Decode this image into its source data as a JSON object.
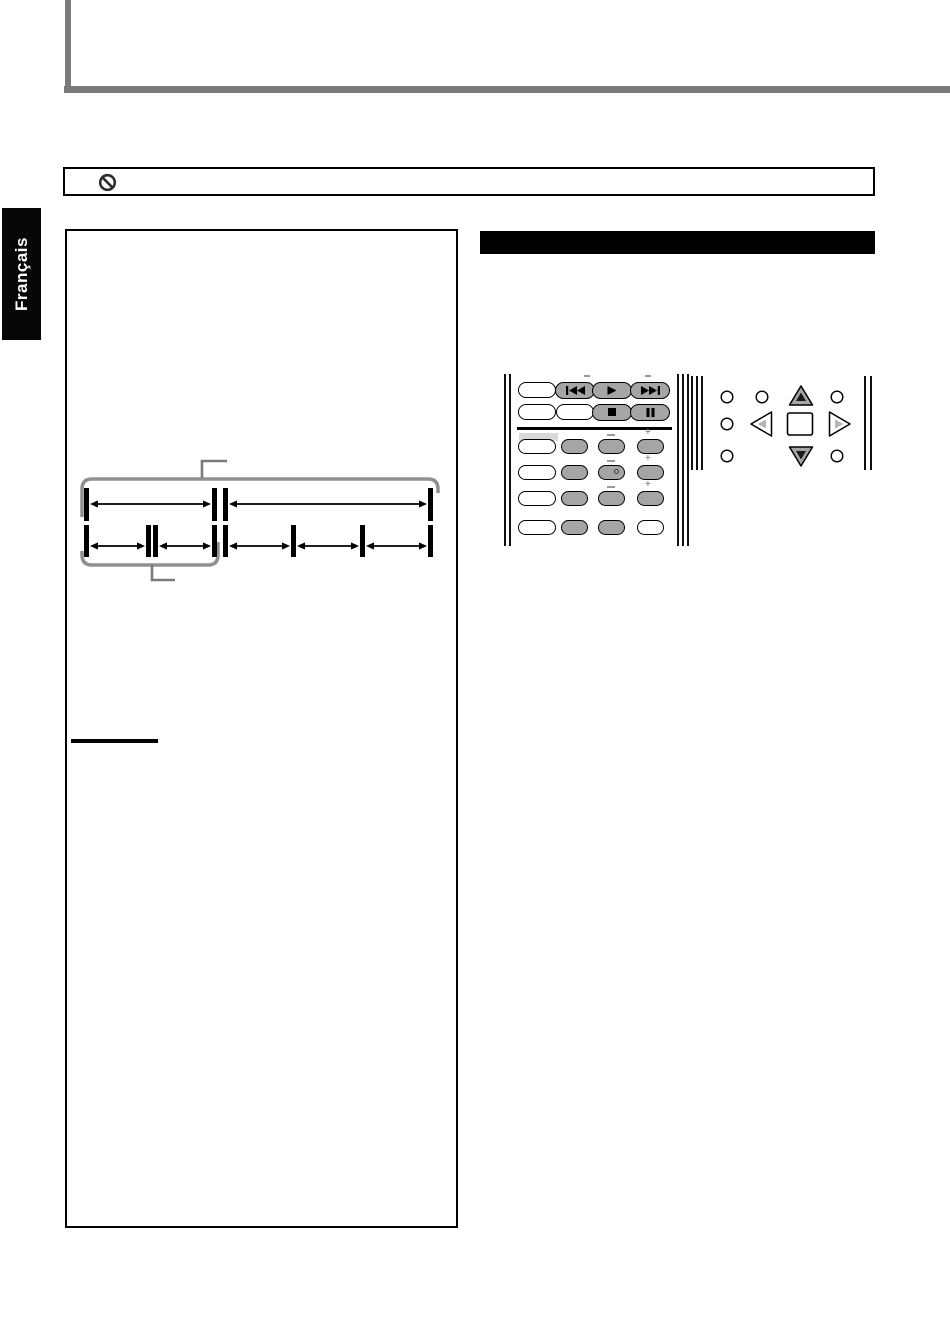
{
  "page": {
    "language_tab": "Français"
  },
  "colors": {
    "rule_gray": "#7a7a7a",
    "bracket_gray": "#909090",
    "callout_gray": "#7a7a7a",
    "button_gray": "#a5a5a5",
    "highlight_gray": "#d9d9d9",
    "mark_gray": "#9a9a9a",
    "black": "#000000",
    "nav_inner_gray": "#b4b4b4"
  },
  "notice": {
    "icon": "prohibition",
    "text": ""
  },
  "section_header": {
    "label": "",
    "style": "solid-black-bar"
  },
  "diagram": {
    "type": "disc-title-chapter-structure",
    "bar_width": 5,
    "bars": [
      {
        "x": 84,
        "y": 488,
        "h": 33
      },
      {
        "x": 212,
        "y": 488,
        "h": 33
      },
      {
        "x": 223,
        "y": 488,
        "h": 33
      },
      {
        "x": 428,
        "y": 488,
        "h": 33
      },
      {
        "x": 84,
        "y": 525,
        "h": 32
      },
      {
        "x": 146,
        "y": 525,
        "h": 32
      },
      {
        "x": 153,
        "y": 525,
        "h": 32
      },
      {
        "x": 212,
        "y": 525,
        "h": 32
      },
      {
        "x": 223,
        "y": 525,
        "h": 32
      },
      {
        "x": 291,
        "y": 525,
        "h": 32
      },
      {
        "x": 360,
        "y": 525,
        "h": 32
      },
      {
        "x": 428,
        "y": 525,
        "h": 32
      }
    ],
    "arrows": [
      {
        "x1": 90,
        "x2": 211,
        "y": 504
      },
      {
        "x1": 229,
        "x2": 427,
        "y": 504
      },
      {
        "x1": 90,
        "x2": 145,
        "y": 546
      },
      {
        "x1": 159,
        "x2": 211,
        "y": 546
      },
      {
        "x1": 229,
        "x2": 290,
        "y": 546
      },
      {
        "x1": 297,
        "x2": 359,
        "y": 546
      },
      {
        "x1": 366,
        "x2": 427,
        "y": 546
      }
    ],
    "brackets": [
      "M 82 517 L 82 489 Q 82 479 92 479 L 428 479 Q 438 479 438 489 L 438 493",
      "M 82 551 L 82 555 Q 82 565 92 565 L 208 565 Q 218 565 218 555 L 218 542"
    ],
    "callouts": [
      "M 202 478 L 202 461 L 227 461",
      "M 152 565 L 152 580 L 175 580"
    ]
  },
  "remote": {
    "left_panel": {
      "edge_y": 374,
      "edge_h": 172,
      "edge_lines_left": [
        504,
        509
      ],
      "edge_lines_right": [
        677,
        682,
        687
      ],
      "divider": {
        "x1": 517,
        "x2": 672,
        "y": 428,
        "h": 3
      },
      "highlight": {
        "x": 519,
        "y": 433,
        "w": 39,
        "h": 8
      },
      "rows": [
        {
          "y": 390,
          "buttons": [
            {
              "cx": 537,
              "w": 38,
              "h": 16,
              "fill": "white",
              "name": "remote-button-blank"
            },
            {
              "cx": 575,
              "w": 40,
              "h": 17,
              "fill": "gray",
              "icon": "skip-back",
              "name": "skip-back-button"
            },
            {
              "cx": 612,
              "w": 40,
              "h": 17,
              "fill": "gray",
              "icon": "play",
              "name": "play-button"
            },
            {
              "cx": 650,
              "w": 40,
              "h": 17,
              "fill": "gray",
              "icon": "skip-forward",
              "name": "skip-forward-button"
            }
          ]
        },
        {
          "y": 412,
          "buttons": [
            {
              "cx": 537,
              "w": 38,
              "h": 16,
              "fill": "white",
              "name": "remote-button-blank"
            },
            {
              "cx": 575,
              "w": 38,
              "h": 16,
              "fill": "white",
              "name": "remote-button-blank"
            },
            {
              "cx": 612,
              "w": 40,
              "h": 17,
              "fill": "gray",
              "icon": "stop",
              "name": "stop-button"
            },
            {
              "cx": 650,
              "w": 40,
              "h": 17,
              "fill": "gray",
              "icon": "pause",
              "name": "pause-button"
            }
          ]
        },
        {
          "y": 446,
          "buttons": [
            {
              "cx": 537,
              "w": 38,
              "h": 15,
              "fill": "white",
              "name": "remote-button-blank"
            },
            {
              "cx": 574,
              "w": 27,
              "h": 15,
              "fill": "gray",
              "name": "remote-button-gray"
            },
            {
              "cx": 611,
              "w": 27,
              "h": 15,
              "fill": "gray",
              "name": "remote-button-gray"
            },
            {
              "cx": 650,
              "w": 27,
              "h": 15,
              "fill": "gray",
              "name": "remote-button-gray"
            }
          ]
        },
        {
          "y": 472,
          "buttons": [
            {
              "cx": 537,
              "w": 38,
              "h": 15,
              "fill": "white",
              "name": "remote-button-blank"
            },
            {
              "cx": 574,
              "w": 27,
              "h": 15,
              "fill": "gray",
              "name": "remote-button-gray"
            },
            {
              "cx": 611,
              "w": 27,
              "h": 15,
              "fill": "gray",
              "name": "remote-button-gray"
            },
            {
              "cx": 650,
              "w": 27,
              "h": 15,
              "fill": "gray",
              "name": "remote-button-gray"
            }
          ]
        },
        {
          "y": 498,
          "buttons": [
            {
              "cx": 537,
              "w": 38,
              "h": 15,
              "fill": "white",
              "name": "remote-button-blank"
            },
            {
              "cx": 574,
              "w": 27,
              "h": 15,
              "fill": "gray",
              "name": "remote-button-gray"
            },
            {
              "cx": 611,
              "w": 27,
              "h": 15,
              "fill": "gray",
              "name": "remote-button-gray"
            },
            {
              "cx": 650,
              "w": 27,
              "h": 15,
              "fill": "gray",
              "name": "remote-button-gray"
            }
          ]
        },
        {
          "y": 527,
          "buttons": [
            {
              "cx": 537,
              "w": 38,
              "h": 15,
              "fill": "white",
              "name": "remote-button-blank"
            },
            {
              "cx": 574,
              "w": 27,
              "h": 15,
              "fill": "gray",
              "name": "remote-button-gray"
            },
            {
              "cx": 611,
              "w": 27,
              "h": 15,
              "fill": "gray",
              "name": "remote-button-gray"
            },
            {
              "cx": 650,
              "w": 27,
              "h": 15,
              "fill": "white",
              "name": "remote-button-blank"
            }
          ]
        }
      ],
      "marks": [
        {
          "type": "dash",
          "x": 584,
          "y": 375,
          "w": 6
        },
        {
          "type": "dash",
          "x": 645,
          "y": 375,
          "w": 6
        },
        {
          "type": "dash",
          "x": 607,
          "y": 434,
          "w": 8
        },
        {
          "type": "plus",
          "x": 645,
          "y": 428
        },
        {
          "type": "dash",
          "x": 607,
          "y": 460,
          "w": 8
        },
        {
          "type": "plus",
          "x": 645,
          "y": 454
        },
        {
          "type": "dash",
          "x": 607,
          "y": 486,
          "w": 8
        },
        {
          "type": "plus",
          "x": 645,
          "y": 480
        }
      ],
      "dot": {
        "x": 614,
        "y": 469
      }
    },
    "right_panel": {
      "edge_y": 376,
      "edge_h": 94,
      "edge_lines_left": [
        691,
        696,
        701
      ],
      "edge_lines_right": [
        864,
        870
      ],
      "circles": [
        [
          727,
          397
        ],
        [
          762,
          397
        ],
        [
          837,
          397
        ],
        [
          727,
          424
        ],
        [
          727,
          456
        ],
        [
          837,
          456
        ]
      ],
      "nav": {
        "up": {
          "cx": 801,
          "cy": 396,
          "dir": "up",
          "fill": "gray"
        },
        "left": {
          "cx": 762,
          "cy": 424,
          "dir": "left",
          "fill": "white"
        },
        "enter": {
          "cx": 800,
          "cy": 424
        },
        "right": {
          "cx": 839,
          "cy": 424,
          "dir": "right",
          "fill": "white"
        },
        "down": {
          "cx": 801,
          "cy": 456,
          "dir": "down",
          "fill": "gray"
        }
      }
    }
  }
}
